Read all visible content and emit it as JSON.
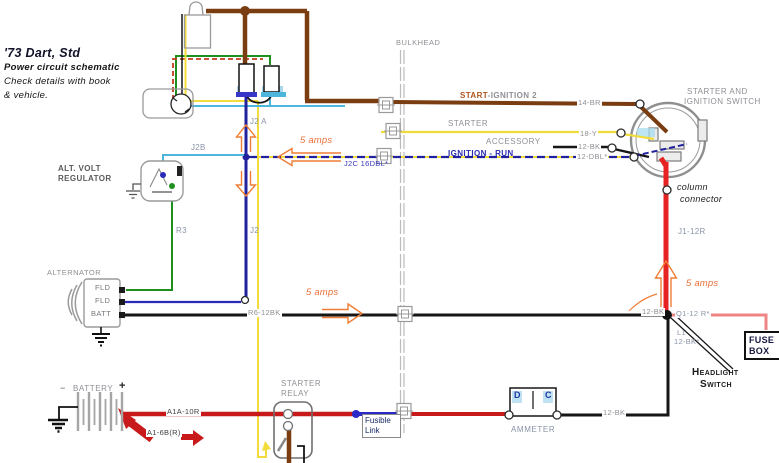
{
  "title": {
    "line1": "'73 Dart, Std",
    "line2": "Power circuit schematic",
    "line3": "Check details with book",
    "line4": "& vehicle."
  },
  "bulkhead": {
    "label": "BULKHEAD"
  },
  "wires": {
    "start_ignition_prefix": "START",
    "start_ignition_suffix": "-IGNITION 2",
    "starter": "STARTER",
    "accessory": "ACCESSORY",
    "ignition_run": "IGNITION - RUN",
    "j2c": "J2C 16DBL*",
    "w14br": "14-BR",
    "w18y": "18-Y",
    "w12bk": "12-BK",
    "w12dbl": "12-DBL*",
    "j1_12r": "J1-12R",
    "q1_12r": "Q1-12 R*",
    "l1": "L1",
    "l1_code": "12-BK*",
    "r6_12bk": "R6-12BK",
    "a1a_10r": "A1A-10R",
    "a1_6b": "A1-6B(R)",
    "j2a": "J2 A",
    "j2b": "J2B",
    "j2": "J2",
    "r3": "R3"
  },
  "components": {
    "ignition_switch_line1": "STARTER AND",
    "ignition_switch_line2": "IGNITION SWITCH",
    "column_line1": "column",
    "column_line2": "connector",
    "fuse_box_line1": "FUSE",
    "fuse_box_line2": "BOX",
    "headlight_line1": "Headlight",
    "headlight_line2": "Switch",
    "ammeter": "AMMETER",
    "ammeter_d": "D",
    "ammeter_c": "C",
    "regulator_line1": "ALT. VOLT",
    "regulator_line2": "REGULATOR",
    "alternator": "ALTERNATOR",
    "alt_fld": "FLD",
    "alt_batt": "BATT",
    "battery": "BATTERY",
    "battery_minus": "−",
    "battery_plus": "+",
    "starter_relay_line1": "STARTER",
    "starter_relay_line2": "RELAY",
    "fusible_line1": "Fusible",
    "fusible_line2": "Link"
  },
  "annotations": {
    "amps5": "5 amps"
  },
  "colors": {
    "brown": "#7a3d12",
    "yellow": "#f2dc3c",
    "dark_blue": "#22229e",
    "light_blue": "#4cb6dc",
    "green": "#1f8f1f",
    "red": "#e62222",
    "dark_red": "#c81a1a",
    "pink": "#ef8484",
    "orange": "#ef7d35",
    "gray": "#8f8f95"
  }
}
